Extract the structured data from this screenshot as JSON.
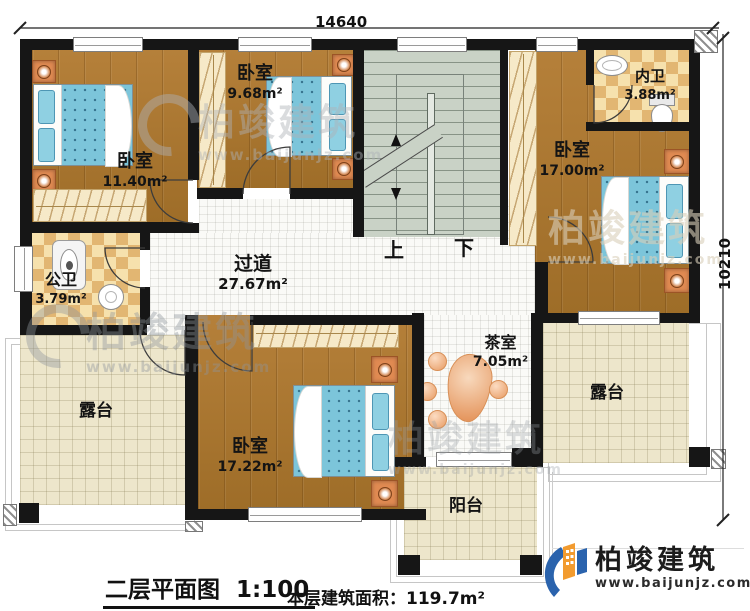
{
  "plan": {
    "dimension_top": "14640",
    "dimension_right": "10210",
    "stairs_up": "上",
    "stairs_down": "下"
  },
  "rooms": {
    "bedroom_top_left": {
      "name": "卧室",
      "area": "11.40m²"
    },
    "bedroom_top_mid": {
      "name": "卧室",
      "area": "9.68m²"
    },
    "bedroom_right": {
      "name": "卧室",
      "area": "17.00m²"
    },
    "bedroom_bottom": {
      "name": "卧室",
      "area": "17.22m²"
    },
    "bath_inner": {
      "name": "内卫",
      "area": "3.88m²"
    },
    "bath_public": {
      "name": "公卫",
      "area": "3.79m²"
    },
    "corridor": {
      "name": "过道",
      "area": "27.67m²"
    },
    "tea_room": {
      "name": "茶室",
      "area": "7.05m²"
    },
    "terrace_left": {
      "name": "露台"
    },
    "terrace_right": {
      "name": "露台"
    },
    "balcony": {
      "name": "阳台"
    }
  },
  "title": {
    "plan_name": "二层平面图",
    "scale": "1:100",
    "area_label": "本层建筑面积：",
    "area_value": "119.7m²"
  },
  "brand": {
    "name": "柏竣建筑",
    "website": "www.baijunjz.com"
  },
  "watermark": {
    "name": "柏竣建筑",
    "website": "www.baijunjz.com"
  },
  "colors": {
    "wall": "#161616",
    "wood_floor": "#aa762f",
    "tile_floor": "#e9c98e",
    "terrace_floor": "#ede6cb",
    "stair_floor": "#c9d2c6",
    "bed": "#7cc5da",
    "furniture_accent": "#e08a52",
    "logo_blue": "#2a63ad",
    "logo_orange": "#f29b2f"
  }
}
